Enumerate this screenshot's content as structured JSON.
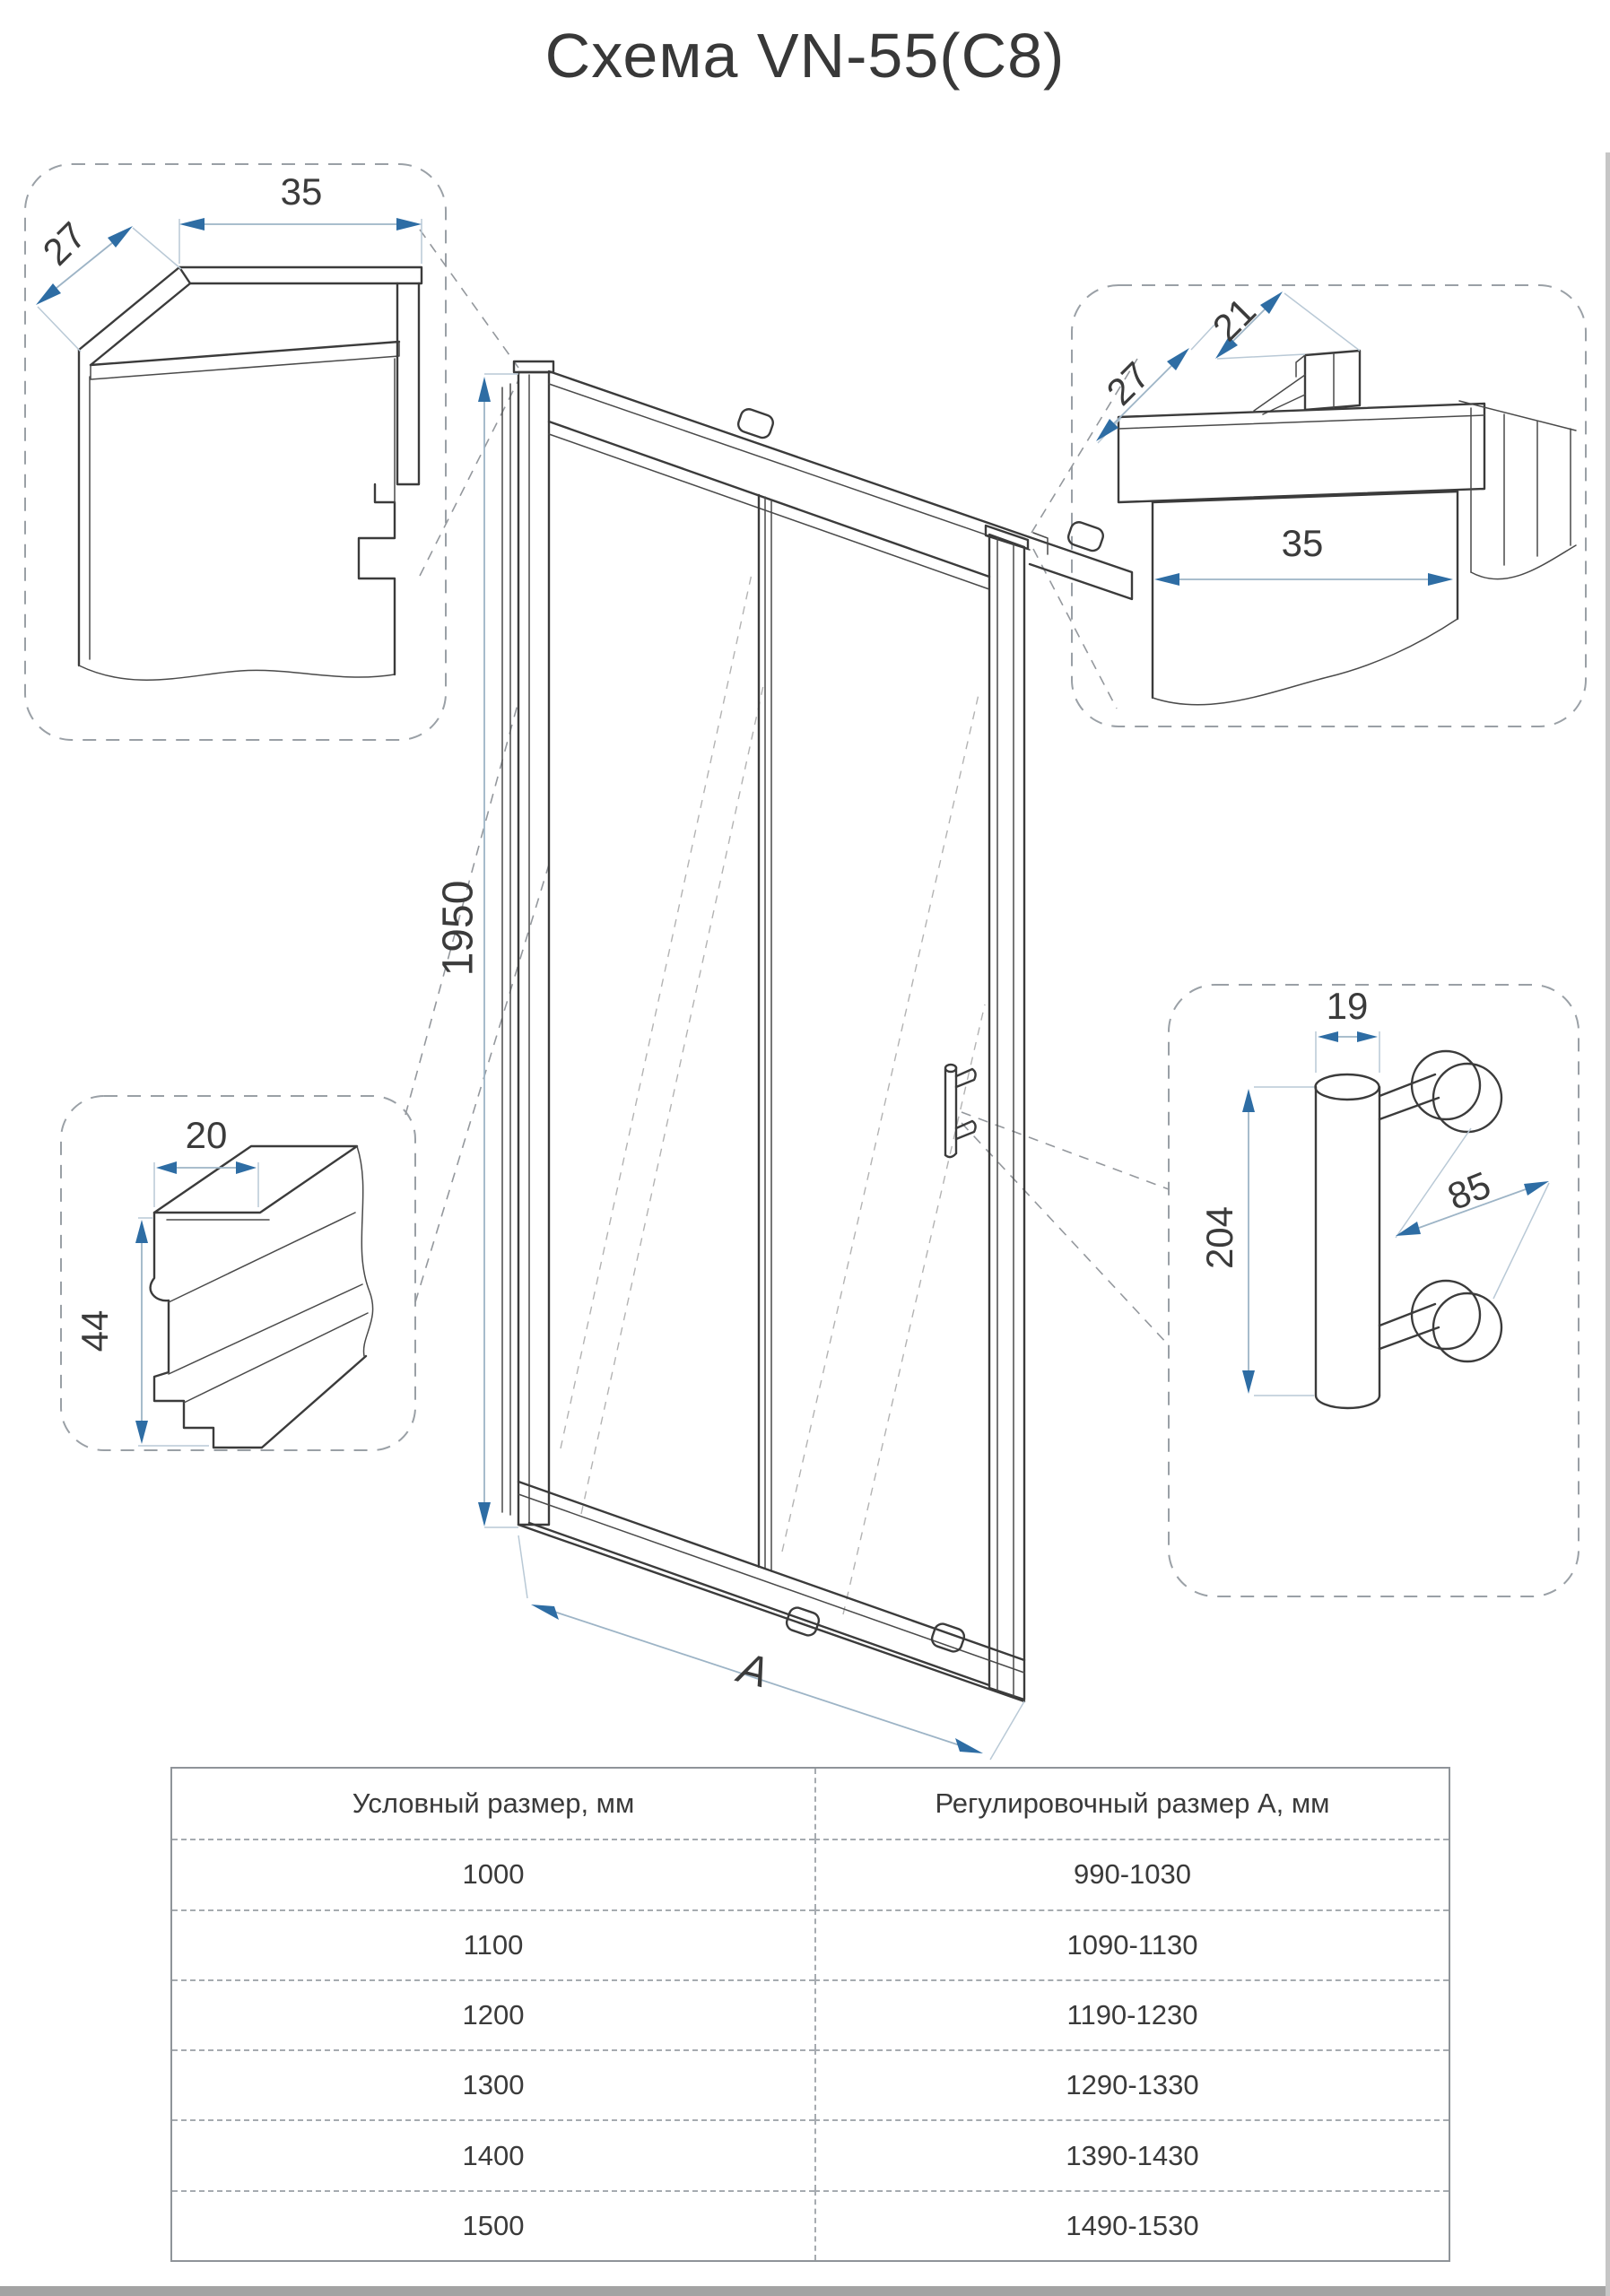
{
  "title": "Схема VN-55(C8)",
  "door": {
    "height": "1950",
    "width": "A"
  },
  "details": {
    "wall_profile_left": {
      "width": "35",
      "depth": "27"
    },
    "wall_profile_right": {
      "glass_slot": "21",
      "depth": "27",
      "width": "35"
    },
    "bottom_rail": {
      "width": "20",
      "height": "44"
    },
    "handle": {
      "diameter": "19",
      "length": "204",
      "hole_spacing": "85"
    }
  },
  "table": {
    "headers": [
      "Условный размер, мм",
      "Регулировочный размер А, мм"
    ],
    "rows": [
      [
        "1000",
        "990-1030"
      ],
      [
        "1100",
        "1090-1130"
      ],
      [
        "1200",
        "1190-1230"
      ],
      [
        "1300",
        "1290-1330"
      ],
      [
        "1400",
        "1390-1430"
      ],
      [
        "1500",
        "1490-1530"
      ]
    ]
  },
  "colors": {
    "accent_blue": "#2e6da4",
    "dim_line": "#9db4c6",
    "line_art": "#3b3b3b",
    "dashed_gray": "#9aa0a6"
  }
}
